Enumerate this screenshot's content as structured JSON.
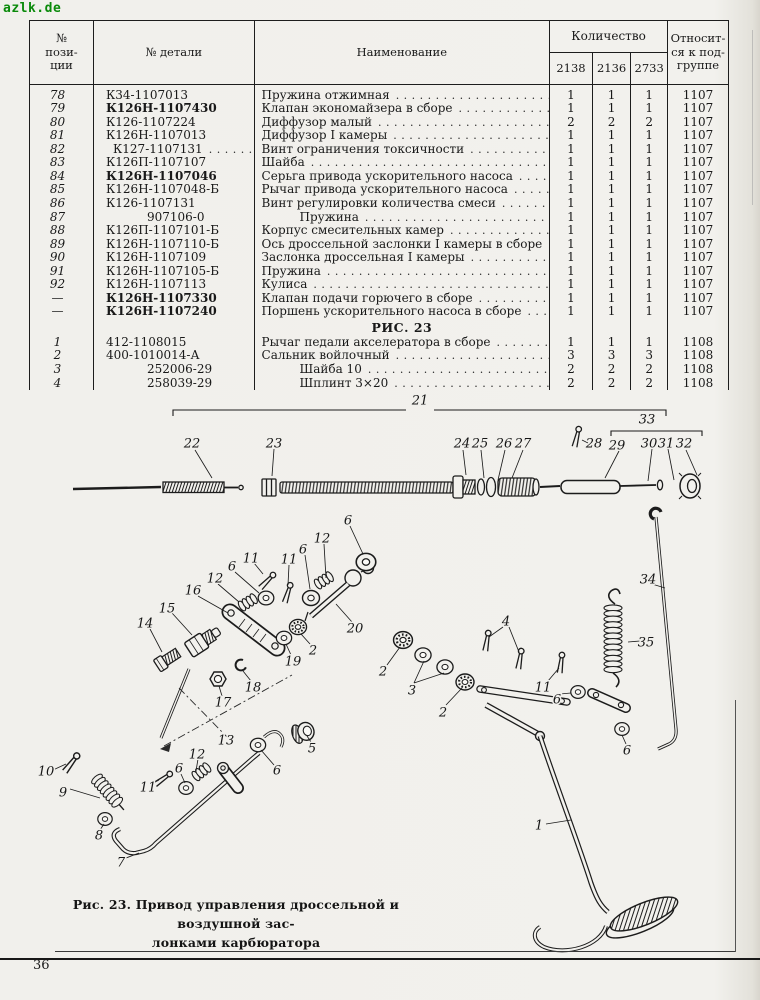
{
  "watermark": "azlk.de",
  "page_number": "36",
  "colors": {
    "paper": "#f1f0ec",
    "ink": "#1b1b1b",
    "watermark_green": "#0a8a0a"
  },
  "table": {
    "header": {
      "pos": "№\nпози-\nции",
      "part": "№ детали",
      "name": "Наименование",
      "qty": "Количество",
      "qty_cols": [
        "2138",
        "2136",
        "2733"
      ],
      "sub": "Относит-\nся к под-\nгруппе"
    },
    "dot_leader": "..........................................",
    "rows": [
      {
        "pos": "78",
        "part": "К34-1107013",
        "name": "Пружина отжимная",
        "dots": true,
        "q": [
          "1",
          "1",
          "1"
        ],
        "sub": "1107"
      },
      {
        "pos": "79",
        "part": "К126Н-1107430",
        "bold": true,
        "name": "Клапан экономайзера в сборе",
        "dots": true,
        "q": [
          "1",
          "1",
          "1"
        ],
        "sub": "1107"
      },
      {
        "pos": "80",
        "part": "К126-1107224",
        "name": "Диффузор малый",
        "dots": true,
        "q": [
          "2",
          "2",
          "2"
        ],
        "sub": "1107"
      },
      {
        "pos": "81",
        "part": "К126Н-1107013",
        "name": "Диффузор I камеры",
        "dots": true,
        "q": [
          "1",
          "1",
          "1"
        ],
        "sub": "1107"
      },
      {
        "pos": "82",
        "part": "К127-1107131",
        "part_dots": true,
        "name": "Винт ограничения токсичности",
        "dots": true,
        "q": [
          "1",
          "1",
          "1"
        ],
        "sub": "1107"
      },
      {
        "pos": "83",
        "part": "К126П-1107107",
        "name": "Шайба",
        "dots": true,
        "q": [
          "1",
          "1",
          "1"
        ],
        "sub": "1107"
      },
      {
        "pos": "84",
        "part": "К126Н-1107046",
        "bold": true,
        "name": "Серьга привода ускорительного насоса",
        "dots": true,
        "q": [
          "1",
          "1",
          "1"
        ],
        "sub": "1107"
      },
      {
        "pos": "85",
        "part": "К126Н-1107048-Б",
        "name": "Рычаг привода ускорительного насоса",
        "dots": true,
        "q": [
          "1",
          "1",
          "1"
        ],
        "sub": "1107"
      },
      {
        "pos": "86",
        "part": "К126-1107131",
        "name": "Винт регулировки количества смеси",
        "dots": true,
        "q": [
          "1",
          "1",
          "1"
        ],
        "sub": "1107"
      },
      {
        "pos": "87",
        "part": "907106-0",
        "part_indent": true,
        "name": "Пружина",
        "name_indent": true,
        "dots": true,
        "q": [
          "1",
          "1",
          "1"
        ],
        "sub": "1107"
      },
      {
        "pos": "88",
        "part": "К126П-1107101-Б",
        "name": "Корпус смесительных камер",
        "dots": true,
        "q": [
          "1",
          "1",
          "1"
        ],
        "sub": "1107"
      },
      {
        "pos": "89",
        "part": "К126Н-1107110-Б",
        "name": "Ось дроссельной заслонки I камеры в сборе",
        "dots": false,
        "q": [
          "1",
          "1",
          "1"
        ],
        "sub": "1107"
      },
      {
        "pos": "90",
        "part": "К126Н-1107109",
        "name": "Заслонка дроссельная I камеры",
        "dots": true,
        "q": [
          "1",
          "1",
          "1"
        ],
        "sub": "1107"
      },
      {
        "pos": "91",
        "part": "К126Н-1107105-Б",
        "name": "Пружина",
        "dots": true,
        "q": [
          "1",
          "1",
          "1"
        ],
        "sub": "1107"
      },
      {
        "pos": "92",
        "part": "К126Н-1107113",
        "name": "Кулиса",
        "dots": true,
        "q": [
          "1",
          "1",
          "1"
        ],
        "sub": "1107"
      },
      {
        "pos": "—",
        "part": "К126Н-1107330",
        "bold": true,
        "name": "Клапан подачи горючего в сборе",
        "dots": true,
        "q": [
          "1",
          "1",
          "1"
        ],
        "sub": "1107"
      },
      {
        "pos": "—",
        "part": "К126Н-1107240",
        "bold": true,
        "name": "Поршень ускорительного насоса в сборе",
        "dots": true,
        "q": [
          "1",
          "1",
          "1"
        ],
        "sub": "1107"
      },
      {
        "section": "РИС. 23"
      },
      {
        "pos": "1",
        "part": "412-1108015",
        "name": "Рычаг педали акселератора в сборе",
        "dots": true,
        "q": [
          "1",
          "1",
          "1"
        ],
        "sub": "1108"
      },
      {
        "pos": "2",
        "part": "400-1010014-А",
        "name": "Сальник войлочный",
        "dots": true,
        "q": [
          "3",
          "3",
          "3"
        ],
        "sub": "1108"
      },
      {
        "pos": "3",
        "part": "252006-29",
        "part_indent": true,
        "name": "Шайба 10",
        "name_indent": true,
        "dots": true,
        "q": [
          "2",
          "2",
          "2"
        ],
        "sub": "1108"
      },
      {
        "pos": "4",
        "part": "258039-29",
        "part_indent": true,
        "name": "Шплинт 3×20",
        "name_indent": true,
        "dots": true,
        "q": [
          "2",
          "2",
          "2"
        ],
        "sub": "1108"
      }
    ]
  },
  "figure": {
    "caption_line1": "Рис. 23.  Привод управления дроссельной и воздушной зас-",
    "caption_line2": "лонками карбюратора",
    "labels": [
      {
        "t": "21",
        "x": 420,
        "y": 12
      },
      {
        "t": "33",
        "x": 647,
        "y": 31
      },
      {
        "t": "22",
        "x": 192,
        "y": 55
      },
      {
        "t": "23",
        "x": 274,
        "y": 55
      },
      {
        "t": "24",
        "x": 462,
        "y": 55
      },
      {
        "t": "25",
        "x": 480,
        "y": 55
      },
      {
        "t": "26",
        "x": 504,
        "y": 55
      },
      {
        "t": "27",
        "x": 523,
        "y": 55
      },
      {
        "t": "28",
        "x": 594,
        "y": 55
      },
      {
        "t": "29",
        "x": 617,
        "y": 57
      },
      {
        "t": "30",
        "x": 649,
        "y": 55
      },
      {
        "t": "31",
        "x": 666,
        "y": 55
      },
      {
        "t": "32",
        "x": 684,
        "y": 55
      },
      {
        "t": "6",
        "x": 348,
        "y": 132
      },
      {
        "t": "12",
        "x": 322,
        "y": 150
      },
      {
        "t": "6",
        "x": 303,
        "y": 161
      },
      {
        "t": "11",
        "x": 289,
        "y": 171
      },
      {
        "t": "11",
        "x": 251,
        "y": 170
      },
      {
        "t": "6",
        "x": 232,
        "y": 178
      },
      {
        "t": "12",
        "x": 215,
        "y": 190
      },
      {
        "t": "16",
        "x": 193,
        "y": 202
      },
      {
        "t": "15",
        "x": 167,
        "y": 220
      },
      {
        "t": "14",
        "x": 145,
        "y": 235
      },
      {
        "t": "20",
        "x": 355,
        "y": 240
      },
      {
        "t": "2",
        "x": 313,
        "y": 262
      },
      {
        "t": "19",
        "x": 293,
        "y": 273
      },
      {
        "t": "2",
        "x": 383,
        "y": 283
      },
      {
        "t": "18",
        "x": 253,
        "y": 299
      },
      {
        "t": "17",
        "x": 223,
        "y": 314
      },
      {
        "t": "4",
        "x": 506,
        "y": 233
      },
      {
        "t": "3",
        "x": 412,
        "y": 302
      },
      {
        "t": "2",
        "x": 443,
        "y": 324
      },
      {
        "t": "11",
        "x": 543,
        "y": 299
      },
      {
        "t": "6",
        "x": 557,
        "y": 311
      },
      {
        "t": "34",
        "x": 648,
        "y": 191
      },
      {
        "t": "35",
        "x": 646,
        "y": 254
      },
      {
        "t": "6",
        "x": 627,
        "y": 362
      },
      {
        "t": "5",
        "x": 312,
        "y": 360
      },
      {
        "t": "6",
        "x": 277,
        "y": 382
      },
      {
        "t": "12",
        "x": 197,
        "y": 366
      },
      {
        "t": "6",
        "x": 179,
        "y": 380
      },
      {
        "t": "11",
        "x": 148,
        "y": 399
      },
      {
        "t": "13",
        "x": 226,
        "y": 352
      },
      {
        "t": "10",
        "x": 46,
        "y": 383
      },
      {
        "t": "9",
        "x": 63,
        "y": 404
      },
      {
        "t": "8",
        "x": 99,
        "y": 447
      },
      {
        "t": "7",
        "x": 121,
        "y": 474
      },
      {
        "t": "1",
        "x": 539,
        "y": 437
      }
    ]
  }
}
